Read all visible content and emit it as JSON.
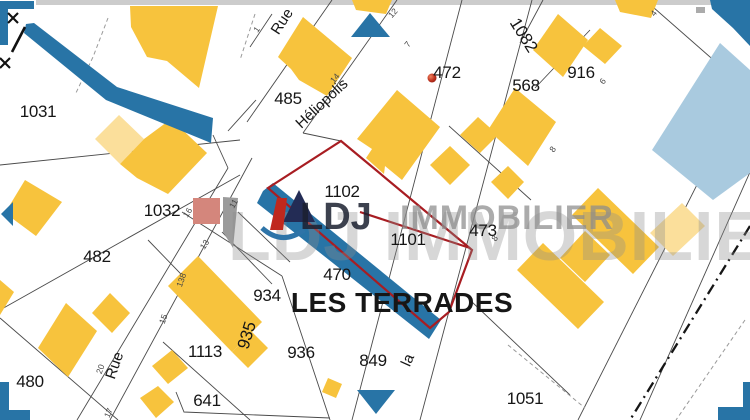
{
  "map": {
    "area_label": "LES TERRADES",
    "watermark": {
      "big": "LDJ IMMOBILIER",
      "brand_bold": "LDJ",
      "brand_rest": "IMMOBILIER"
    },
    "selected_parcels": [
      "1102",
      "1101"
    ],
    "colors": {
      "building": "#F7C33D",
      "building_light": "#FBDF9B",
      "water": "#2874A6",
      "water_light": "#A9CADF",
      "selection": "#A81D22",
      "salmon": "#D4867C",
      "gray_building": "#9B9B9B",
      "line": "#4A4A4A",
      "label": "#161616",
      "tiny": "#474747",
      "watermark": "#8C8C8C"
    },
    "parcel_labels": [
      {
        "text": "1031",
        "x": 38,
        "y": 117
      },
      {
        "text": "1032",
        "x": 162,
        "y": 216
      },
      {
        "text": "482",
        "x": 97,
        "y": 262
      },
      {
        "text": "480",
        "x": 30,
        "y": 387
      },
      {
        "text": "485",
        "x": 288,
        "y": 104
      },
      {
        "text": "1102",
        "x": 342,
        "y": 197
      },
      {
        "text": "1101",
        "x": 408,
        "y": 245
      },
      {
        "text": "473",
        "x": 483,
        "y": 236
      },
      {
        "text": "470",
        "x": 337,
        "y": 280
      },
      {
        "text": "934",
        "x": 267,
        "y": 301
      },
      {
        "text": "935",
        "x": 252,
        "y": 337,
        "rot": -73
      },
      {
        "text": "936",
        "x": 301,
        "y": 358
      },
      {
        "text": "1113",
        "x": 205,
        "y": 357
      },
      {
        "text": "641",
        "x": 207,
        "y": 406
      },
      {
        "text": "849",
        "x": 373,
        "y": 366
      },
      {
        "text": "568",
        "x": 526,
        "y": 91
      },
      {
        "text": "916",
        "x": 581,
        "y": 78
      },
      {
        "text": "1082",
        "x": 519,
        "y": 38,
        "rot": 58
      },
      {
        "text": "472",
        "x": 447,
        "y": 78
      },
      {
        "text": "1051",
        "x": 525,
        "y": 404
      }
    ],
    "street_labels": [
      {
        "text": "Rue",
        "x": 286,
        "y": 24,
        "rot": -57
      },
      {
        "text": "Héliopolis",
        "x": 325,
        "y": 107,
        "rot": -43
      },
      {
        "text": "Rue",
        "x": 119,
        "y": 367,
        "rot": -71
      },
      {
        "text": "la",
        "x": 412,
        "y": 362,
        "rot": -66
      }
    ],
    "house_numbers": [
      {
        "text": "1",
        "x": 259,
        "y": 31,
        "rot": -55
      },
      {
        "text": "14",
        "x": 337,
        "y": 80,
        "rot": -50
      },
      {
        "text": "7",
        "x": 410,
        "y": 46,
        "rot": -52
      },
      {
        "text": "12",
        "x": 395,
        "y": 15,
        "rot": -48
      },
      {
        "text": "4",
        "x": 656,
        "y": 15,
        "rot": -52
      },
      {
        "text": "6",
        "x": 605,
        "y": 83,
        "rot": -52
      },
      {
        "text": "8",
        "x": 555,
        "y": 151,
        "rot": -52
      },
      {
        "text": "8",
        "x": 497,
        "y": 240,
        "rot": -52
      },
      {
        "text": "16",
        "x": 190,
        "y": 214,
        "rot": -57
      },
      {
        "text": "11",
        "x": 236,
        "y": 205,
        "rot": -60
      },
      {
        "text": "13",
        "x": 207,
        "y": 246,
        "rot": -57
      },
      {
        "text": "138",
        "x": 184,
        "y": 281,
        "rot": -70
      },
      {
        "text": "15",
        "x": 166,
        "y": 320,
        "rot": -70
      },
      {
        "text": "20",
        "x": 103,
        "y": 370,
        "rot": -70
      },
      {
        "text": "17",
        "x": 111,
        "y": 414,
        "rot": -66
      }
    ]
  }
}
